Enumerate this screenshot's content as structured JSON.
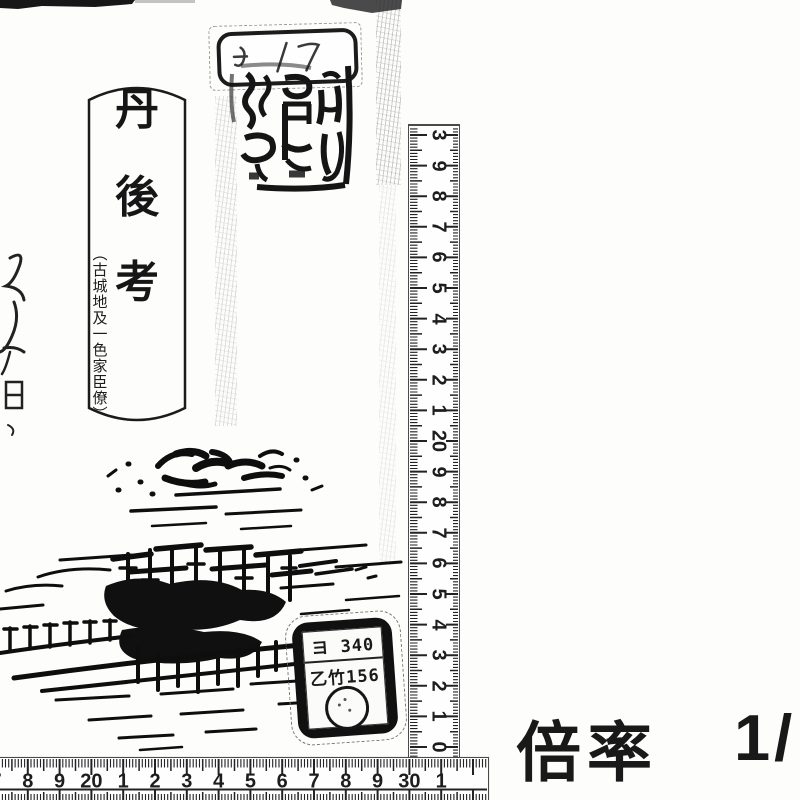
{
  "title_slip": {
    "chars": [
      "丹",
      "後",
      "考"
    ],
    "subtitle": "（古城地及一色家臣僚）"
  },
  "call_label": {
    "line1": "ヨ 340",
    "line2": "乙竹156"
  },
  "vertical_ruler": {
    "unit": "cm",
    "labels": [
      "3",
      "9",
      "8",
      "7",
      "6",
      "5",
      "4",
      "3",
      "2",
      "1",
      "20",
      "9",
      "8",
      "7",
      "6",
      "5",
      "4",
      "3",
      "2",
      "1",
      "0"
    ]
  },
  "horizontal_ruler": {
    "unit": "cm",
    "labels": [
      "7",
      "8",
      "9",
      "20",
      "1",
      "2",
      "3",
      "4",
      "5",
      "6",
      "7",
      "8",
      "9",
      "30",
      "1"
    ]
  },
  "magnification": {
    "label": "倍率",
    "value": "1/"
  }
}
